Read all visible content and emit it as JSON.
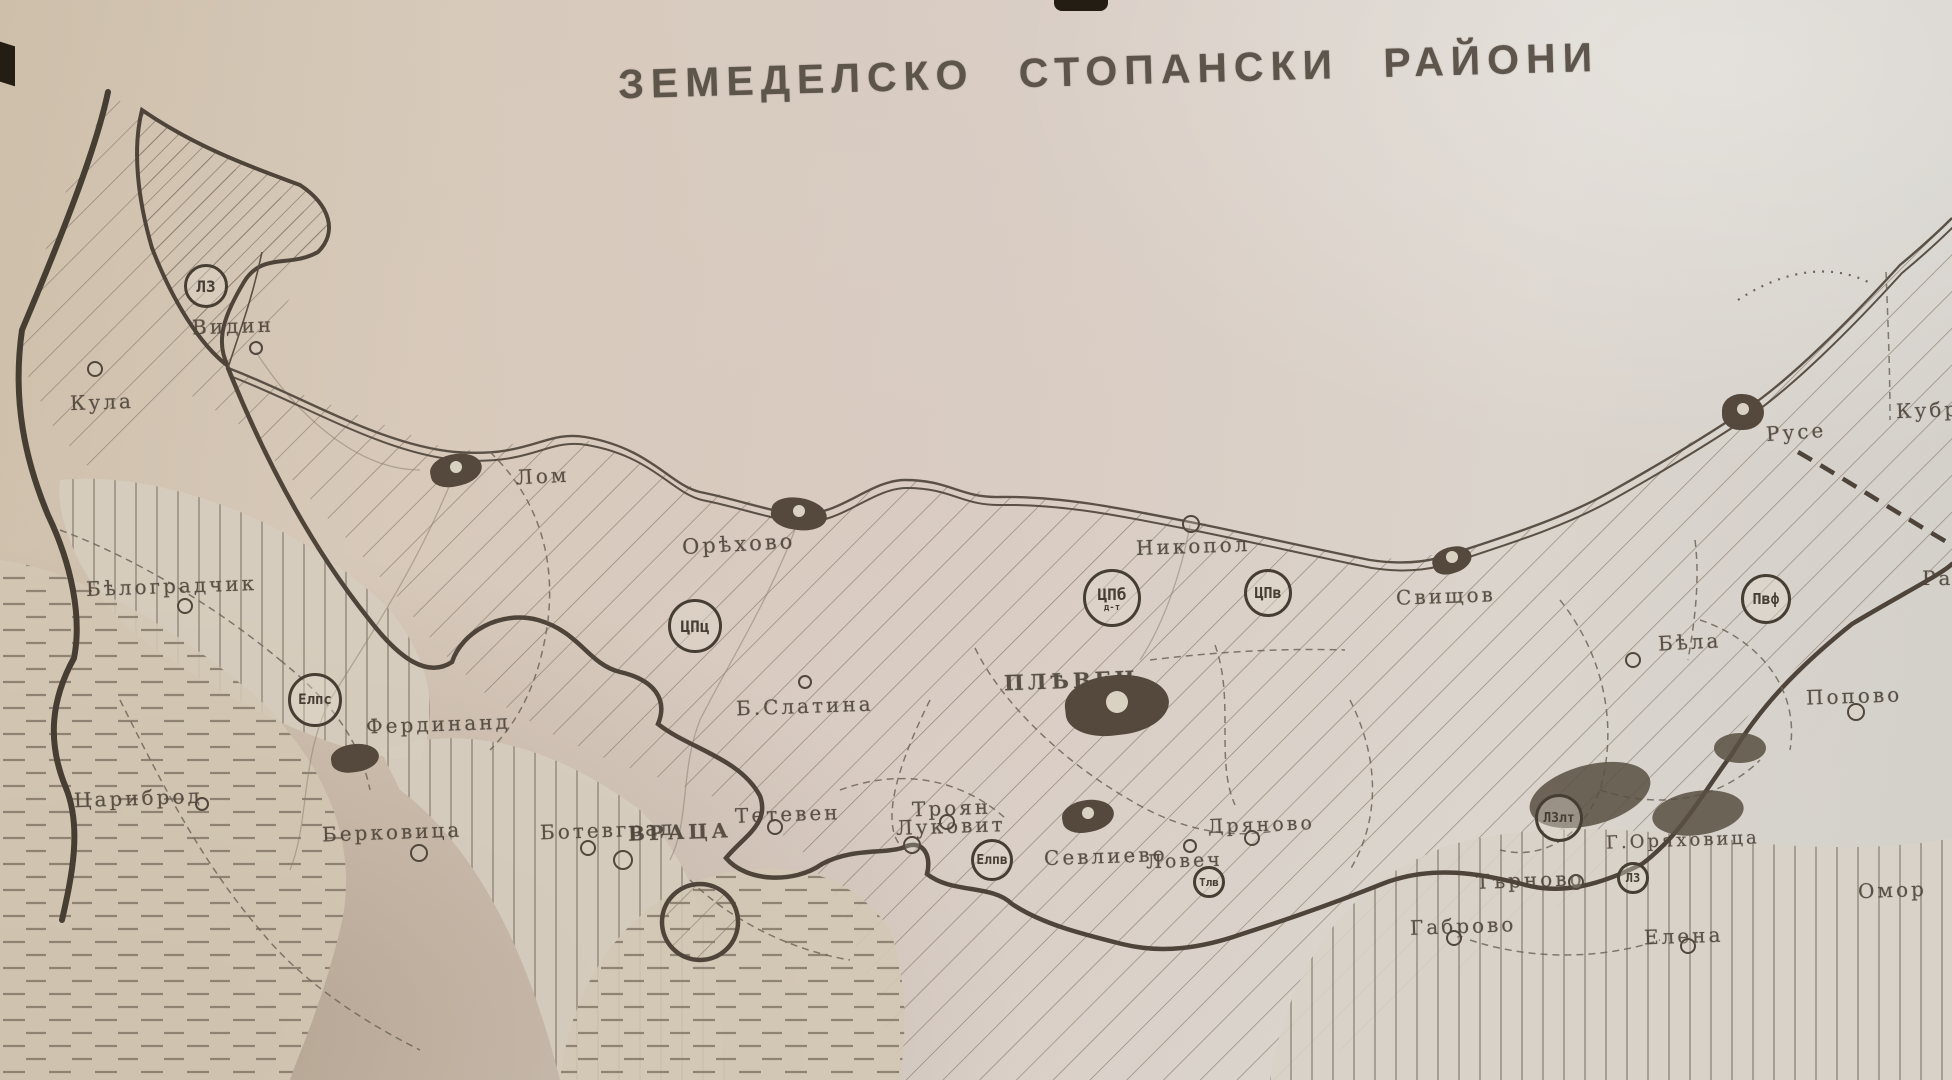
{
  "title": "ЗЕМЕДЕЛСКО СТОПАНСКИ РАЙОНИ",
  "colors": {
    "ink": "#51473c",
    "label": "#4f463b",
    "hatch": "#877a6b",
    "paper_warm": "#d2c5b2",
    "paper_light": "#dbd6cf",
    "blob": "#55493d"
  },
  "map": {
    "river": "Дунав",
    "towns": [
      {
        "name": "Видин",
        "x": 192,
        "y": 314,
        "fs": 20,
        "rot": -2,
        "marker": {
          "type": "circle",
          "cx": 256,
          "cy": 348,
          "r": 7
        }
      },
      {
        "name": "Кула",
        "x": 70,
        "y": 390,
        "fs": 20,
        "rot": -2,
        "marker": {
          "type": "circle",
          "cx": 95,
          "cy": 369,
          "r": 8
        }
      },
      {
        "name": "Лом",
        "x": 516,
        "y": 464,
        "fs": 20,
        "rot": -3,
        "marker": {
          "type": "blob",
          "cx": 456,
          "cy": 470,
          "rx": 26,
          "ry": 16,
          "rot": -12,
          "hole": true
        }
      },
      {
        "name": "Орѣхово",
        "x": 682,
        "y": 532,
        "fs": 21,
        "rot": -3,
        "marker": {
          "type": "blob",
          "cx": 799,
          "cy": 514,
          "rx": 28,
          "ry": 16,
          "rot": 8,
          "hole": true
        }
      },
      {
        "name": "Никопол",
        "x": 1136,
        "y": 534,
        "fs": 20,
        "rot": -2,
        "marker": {
          "type": "circle",
          "cx": 1191,
          "cy": 524,
          "r": 9
        }
      },
      {
        "name": "Свищов",
        "x": 1396,
        "y": 584,
        "fs": 20,
        "rot": -2,
        "marker": {
          "type": "blob",
          "cx": 1452,
          "cy": 560,
          "rx": 20,
          "ry": 13,
          "rot": -18,
          "hole": true
        }
      },
      {
        "name": "Русе",
        "x": 1766,
        "y": 420,
        "fs": 20,
        "rot": -4,
        "marker": {
          "type": "blob",
          "cx": 1743,
          "cy": 412,
          "rx": 21,
          "ry": 18,
          "rot": 0,
          "hole": true
        }
      },
      {
        "name": "Кубр",
        "x": 1896,
        "y": 398,
        "fs": 20,
        "rot": -2,
        "marker": null
      },
      {
        "name": "Ра",
        "x": 1922,
        "y": 566,
        "fs": 20,
        "rot": 0,
        "marker": null
      },
      {
        "name": "Бѣла",
        "x": 1658,
        "y": 630,
        "fs": 20,
        "rot": -3,
        "marker": {
          "type": "circle",
          "cx": 1633,
          "cy": 660,
          "r": 8
        }
      },
      {
        "name": "Попово",
        "x": 1806,
        "y": 684,
        "fs": 20,
        "rot": -2,
        "marker": {
          "type": "circle",
          "cx": 1856,
          "cy": 712,
          "r": 9
        }
      },
      {
        "name": "Б.Слатина",
        "x": 736,
        "y": 694,
        "fs": 20,
        "rot": -2,
        "marker": {
          "type": "circle",
          "cx": 805,
          "cy": 682,
          "r": 7
        }
      },
      {
        "name": "ПЛѢВЕН",
        "x": 1004,
        "y": 668,
        "fs": 21,
        "bold": true,
        "rot": -2,
        "marker": {
          "type": "blob",
          "cx": 1117,
          "cy": 705,
          "rx": 52,
          "ry": 30,
          "rot": -6,
          "hole": true,
          "hr": 11
        }
      },
      {
        "name": "Бѣлоградчик",
        "x": 86,
        "y": 574,
        "fs": 20,
        "rot": -2,
        "marker": {
          "type": "circle",
          "cx": 185,
          "cy": 606,
          "r": 8
        }
      },
      {
        "name": "Фердинанд",
        "x": 366,
        "y": 712,
        "fs": 20,
        "rot": -2,
        "marker": {
          "type": "blob",
          "cx": 355,
          "cy": 758,
          "rx": 24,
          "ry": 14,
          "rot": -8,
          "hole": false
        }
      },
      {
        "name": "Берковица",
        "x": 322,
        "y": 820,
        "fs": 20,
        "rot": -2,
        "marker": {
          "type": "circle",
          "cx": 419,
          "cy": 853,
          "r": 9
        }
      },
      {
        "name": "ВРАЦА",
        "x": 628,
        "y": 820,
        "fs": 20,
        "bold": true,
        "rot": -2,
        "marker": {
          "type": "circle",
          "cx": 623,
          "cy": 860,
          "r": 10
        }
      },
      {
        "name": "Луковит",
        "x": 896,
        "y": 814,
        "fs": 20,
        "rot": -2,
        "marker": {
          "type": "circle",
          "cx": 912,
          "cy": 845,
          "r": 9
        }
      },
      {
        "name": "Ловеч",
        "x": 1146,
        "y": 850,
        "fs": 19,
        "rot": -2,
        "marker": {
          "type": "circle",
          "cx": 1190,
          "cy": 846,
          "r": 7
        }
      },
      {
        "name": "Цариброд",
        "x": 74,
        "y": 786,
        "fs": 20,
        "rot": -2,
        "marker": {
          "type": "circle",
          "cx": 202,
          "cy": 804,
          "r": 7
        }
      },
      {
        "name": "Ботевград",
        "x": 540,
        "y": 818,
        "fs": 20,
        "rot": -2,
        "marker": {
          "type": "circle",
          "cx": 588,
          "cy": 848,
          "r": 8
        }
      },
      {
        "name": "Тетевен",
        "x": 735,
        "y": 802,
        "fs": 20,
        "rot": -2,
        "marker": {
          "type": "circle",
          "cx": 775,
          "cy": 827,
          "r": 8
        }
      },
      {
        "name": "Троян",
        "x": 912,
        "y": 796,
        "fs": 20,
        "rot": -2,
        "marker": {
          "type": "circle",
          "cx": 947,
          "cy": 822,
          "r": 8
        }
      },
      {
        "name": "Севлиево",
        "x": 1044,
        "y": 844,
        "fs": 20,
        "rot": -2,
        "marker": {
          "type": "blob",
          "cx": 1088,
          "cy": 816,
          "rx": 26,
          "ry": 16,
          "rot": -10,
          "hole": true
        }
      },
      {
        "name": "Дряново",
        "x": 1208,
        "y": 814,
        "fs": 19,
        "rot": -2,
        "marker": {
          "type": "circle",
          "cx": 1252,
          "cy": 838,
          "r": 8
        }
      },
      {
        "name": "Търново",
        "x": 1476,
        "y": 868,
        "fs": 20,
        "rot": -2,
        "marker": {
          "type": "circle",
          "cx": 1576,
          "cy": 882,
          "r": 8
        }
      },
      {
        "name": "Г.Оряховица",
        "x": 1606,
        "y": 830,
        "fs": 18,
        "rot": -2,
        "marker": null
      },
      {
        "name": "Габрово",
        "x": 1410,
        "y": 914,
        "fs": 20,
        "rot": -2,
        "marker": {
          "type": "circle",
          "cx": 1454,
          "cy": 938,
          "r": 8
        }
      },
      {
        "name": "Елена",
        "x": 1644,
        "y": 924,
        "fs": 20,
        "rot": -2,
        "marker": {
          "type": "circle",
          "cx": 1688,
          "cy": 946,
          "r": 8
        }
      },
      {
        "name": "Омор",
        "x": 1858,
        "y": 878,
        "fs": 20,
        "rot": -2,
        "marker": null
      }
    ],
    "district_markers": [
      {
        "code": "ЛЗ",
        "x": 206,
        "y": 286,
        "r": 22,
        "fs": 16
      },
      {
        "code": "ЦПц",
        "x": 695,
        "y": 626,
        "r": 27,
        "fs": 16
      },
      {
        "code": "ЦПб",
        "sub": "д-т",
        "x": 1112,
        "y": 598,
        "r": 29,
        "fs": 16
      },
      {
        "code": "ЦПв",
        "x": 1268,
        "y": 593,
        "r": 24,
        "fs": 15
      },
      {
        "code": "Пвф",
        "x": 1766,
        "y": 599,
        "r": 25,
        "fs": 15
      },
      {
        "code": "Елпс",
        "x": 315,
        "y": 700,
        "r": 27,
        "fs": 14
      },
      {
        "code": "Елпв",
        "x": 992,
        "y": 860,
        "r": 21,
        "fs": 13
      },
      {
        "code": "Тлв",
        "x": 1209,
        "y": 882,
        "r": 16,
        "fs": 11
      },
      {
        "code": "ЛЗлт",
        "x": 1559,
        "y": 818,
        "r": 24,
        "fs": 13
      },
      {
        "code": "ЛЗ",
        "x": 1633,
        "y": 878,
        "r": 16,
        "fs": 12
      }
    ]
  }
}
